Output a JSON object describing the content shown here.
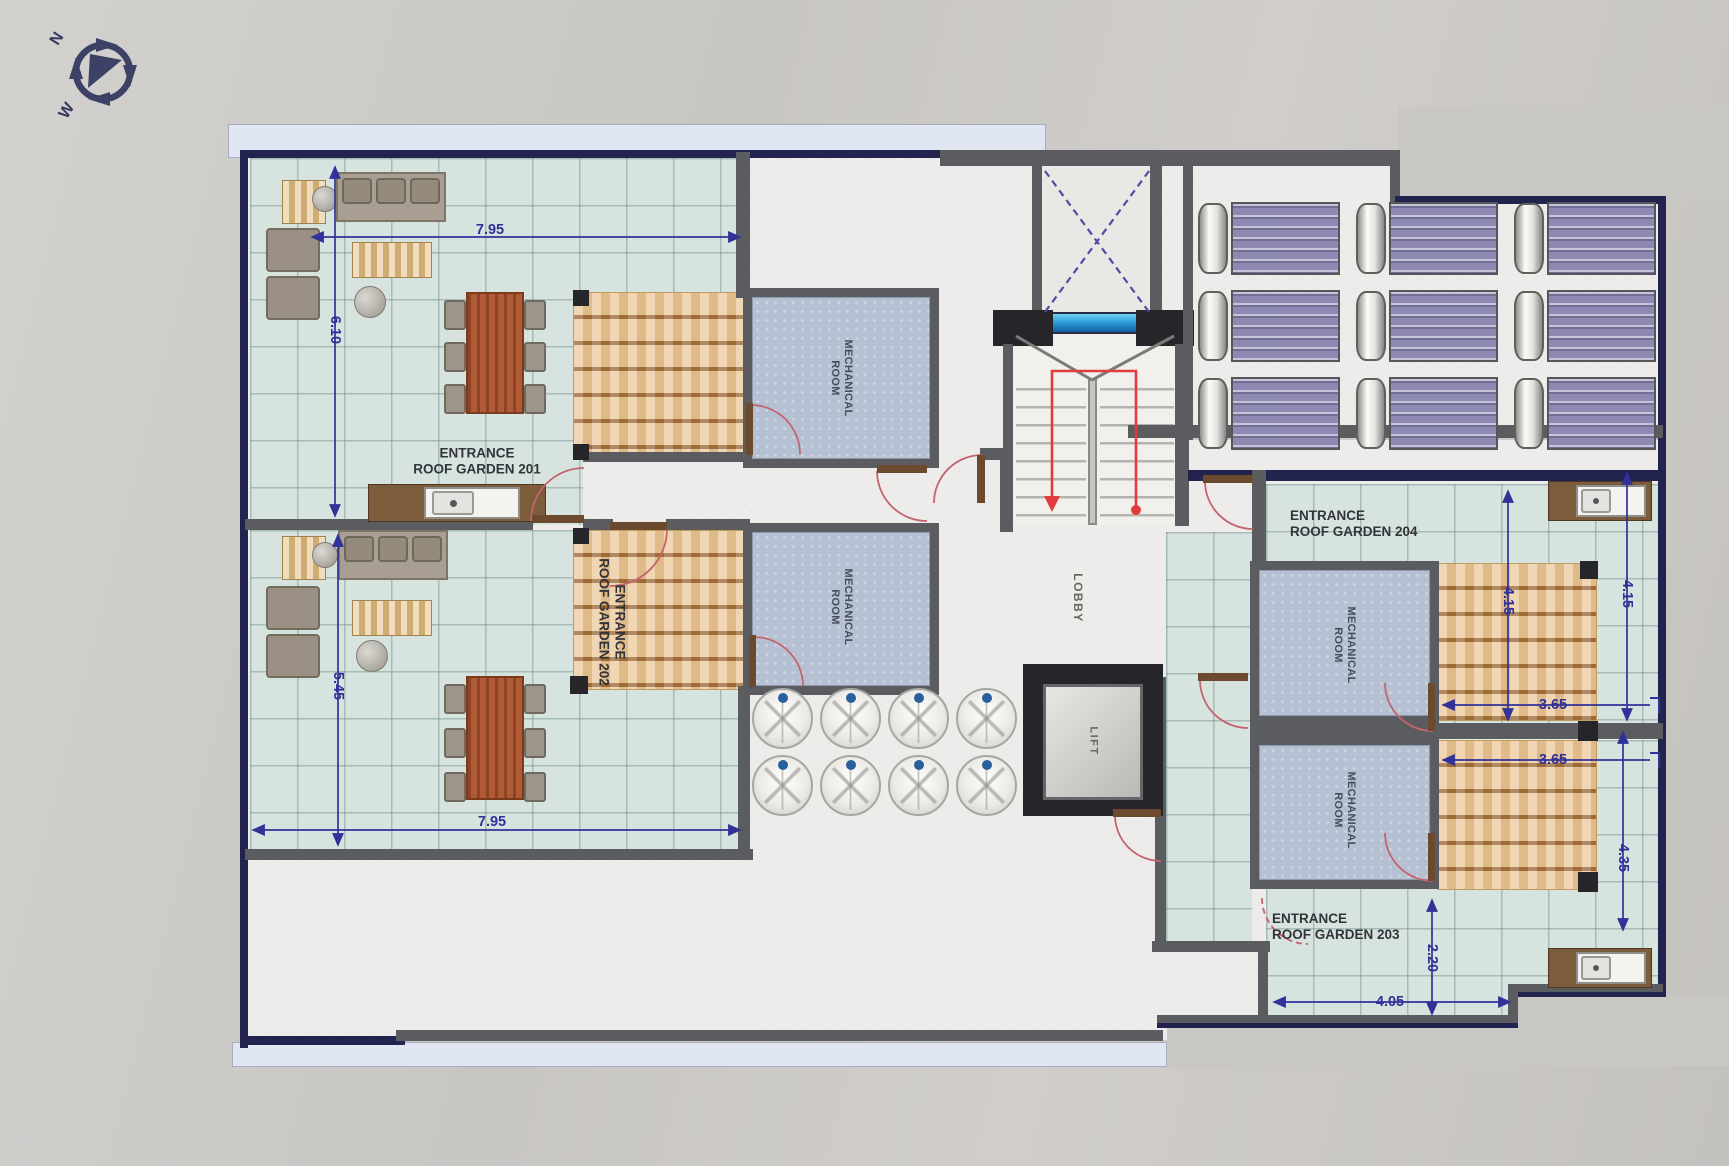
{
  "compass": {
    "north": "N",
    "west": "W"
  },
  "rooms": {
    "lobby": "LOBBY",
    "lift": "LIFT",
    "mechanical": {
      "line1": "MECHANICAL",
      "line2": "ROOM"
    }
  },
  "entrances": {
    "g201": {
      "line1": "ENTRANCE",
      "line2": "ROOF GARDEN 201"
    },
    "g202": {
      "line1": "ENTRANCE",
      "line2": "ROOF GARDEN 202"
    },
    "g203": {
      "line1": "ENTRANCE",
      "line2": "ROOF GARDEN 203"
    },
    "g204": {
      "line1": "ENTRANCE",
      "line2": "ROOF GARDEN 204"
    }
  },
  "dimensions": {
    "garden201_width": "7.95",
    "garden201_depth": "6.10",
    "garden202_depth": "5.45",
    "garden202_width": "7.95",
    "garden204_pergola_depth": "4.15",
    "garden204_edge_depth": "4.15",
    "garden204_pergola_width": "3.65",
    "garden203_pergola_width": "3.65",
    "garden203_edge_depth": "4.35",
    "garden203_entry_depth": "2.20",
    "garden203_bottom_width": "4.05"
  },
  "features": {
    "solar_collector_count": 9,
    "skylight_dome_count": 8
  },
  "colors": {
    "tile": "#d7e3df",
    "wall": "#5b5c60",
    "outline": "#23234f",
    "pergola": "#ecca9c",
    "mechanical_fill": "#b5c1d3",
    "solar_panel": "#8d89b2",
    "dimension": "#31319a",
    "door_arc": "#c4646e",
    "stair_path": "#e23d3d",
    "skylight_blue": "#36a9e0"
  }
}
